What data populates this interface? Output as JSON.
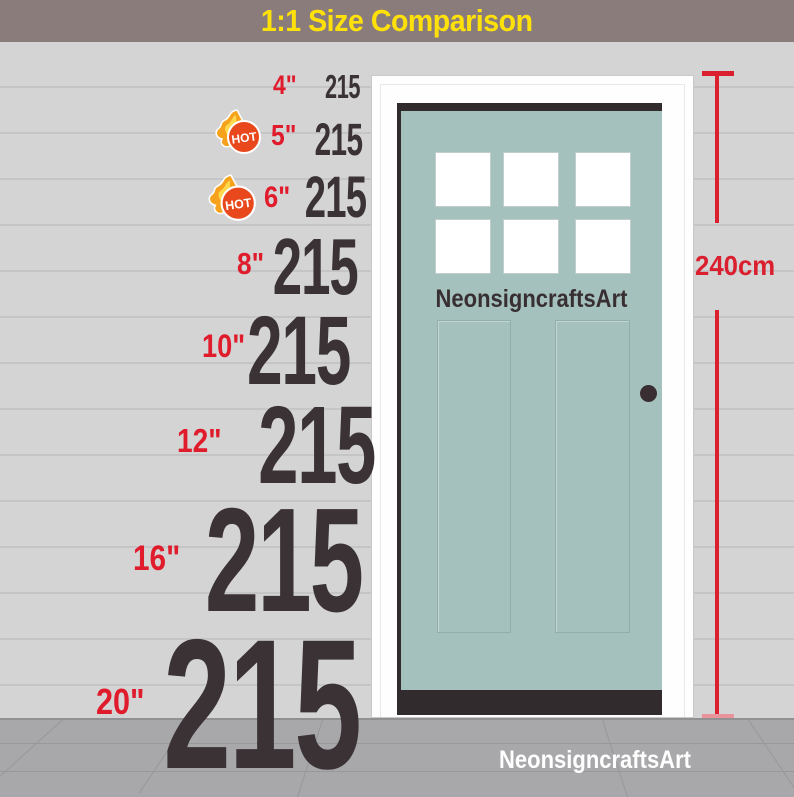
{
  "header": {
    "title": "1:1 Size Comparison"
  },
  "brand": {
    "door_text": "NeonsigncraftsArt",
    "floor_watermark": "NeonsigncraftsArt"
  },
  "measurement": {
    "door_height_label": "240cm"
  },
  "hot_badge": {
    "label": "HOT"
  },
  "sizes": [
    {
      "label": "4\"",
      "value": "215",
      "hot": false
    },
    {
      "label": "5\"",
      "value": "215",
      "hot": true
    },
    {
      "label": "6\"",
      "value": "215",
      "hot": true
    },
    {
      "label": "8\"",
      "value": "215",
      "hot": false
    },
    {
      "label": "10\"",
      "value": "215",
      "hot": false
    },
    {
      "label": "12\"",
      "value": "215",
      "hot": false
    },
    {
      "label": "16\"",
      "value": "215",
      "hot": false
    },
    {
      "label": "20\"",
      "value": "215",
      "hot": false
    }
  ],
  "colors": {
    "header_bg": "#8b7c7c",
    "header_text": "#ffe10a",
    "accent_red": "#da1f2e",
    "numeral_dark": "#3a3234",
    "door_teal": "#a5c1bd",
    "wall_gray": "#d4d4d5",
    "floor_gray": "#a8a8aa"
  }
}
